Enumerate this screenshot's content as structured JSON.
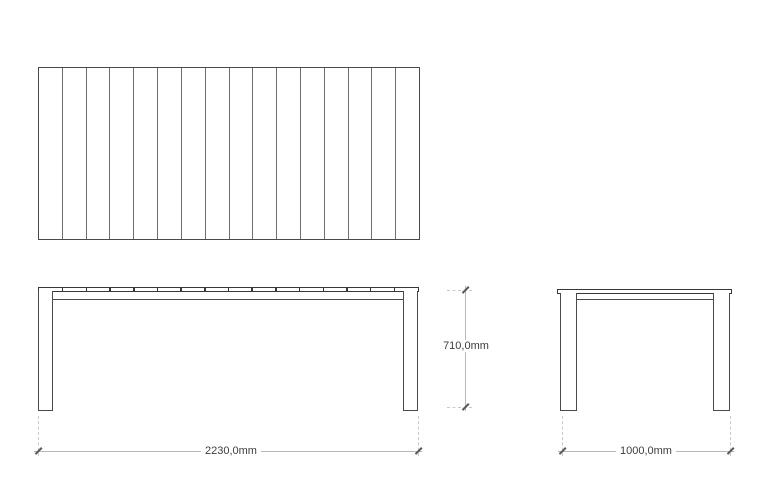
{
  "drawing": {
    "subject": "rectangular-slatted-table-technical-drawing",
    "top_view": {
      "slat_count": 16
    },
    "front_view": {
      "gap_tick_count": 15
    },
    "dimensions": {
      "width_label": "2230,0mm",
      "height_label": "710,0mm",
      "depth_label": "1000,0mm"
    },
    "colors": {
      "object_line": "#4a4a4a",
      "tabletop_line": "#383838",
      "slat_divider": "#6e6e6e",
      "dimension_line": "#b8b8b8",
      "extension_line": "#c9c9c9",
      "dimension_tick": "#5a5a5a",
      "label_text": "#3d3d3d",
      "background": "#ffffff"
    }
  }
}
